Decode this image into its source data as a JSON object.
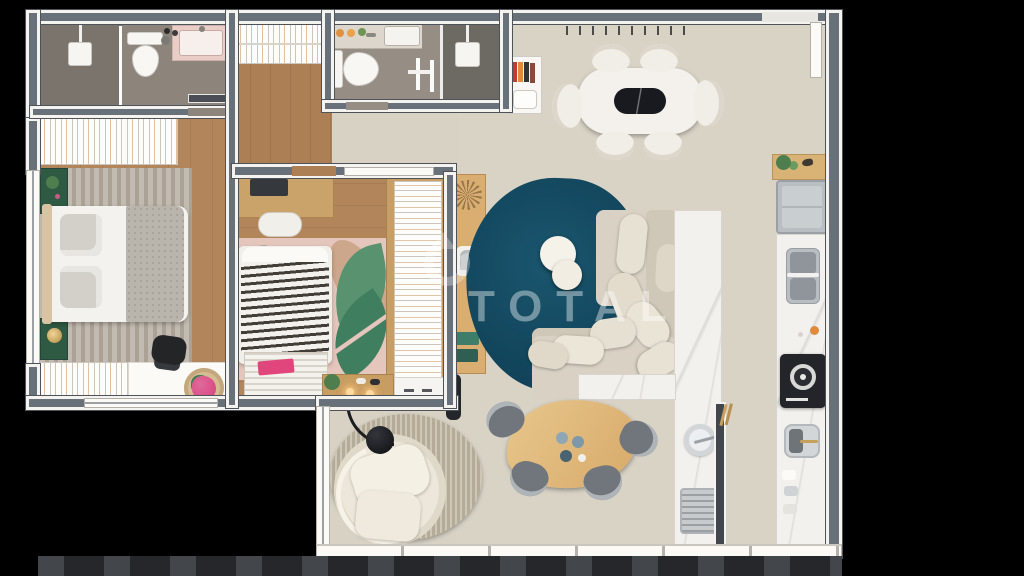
{
  "watermark": {
    "text": "TOTAL"
  },
  "scene": {
    "type": "apartment-floor-plan-3d-render",
    "view": "top-down",
    "background": "#000000"
  },
  "palette": {
    "wall_core": "#687079",
    "wall_edge": "#f4f3ef",
    "living_floor": "#d9d3c6",
    "wood_floor": "#b2855a",
    "bath_floor": "#93897f",
    "shower_floor": "#6d6963",
    "teal_rug": "#14506a",
    "wood_furniture": "#d9ae70",
    "sofa_beige": "#d8d1c3",
    "marble": "#f3f1ed",
    "green_accent": "#2e5a43",
    "pink_accent": "#d6407e",
    "cooktop_black": "#23252b",
    "fridge_gray": "#b9bec2",
    "exterior_band": "#25272b"
  },
  "rooms": [
    {
      "name": "ensuite-bathroom",
      "furniture": [
        "walk-in-shower",
        "toilet",
        "vanity-sink"
      ]
    },
    {
      "name": "hallway",
      "furniture": [
        "slatted-closet"
      ]
    },
    {
      "name": "bathroom-2",
      "furniture": [
        "vanity-sink",
        "toilet",
        "towel-rail",
        "shower-cabin"
      ]
    },
    {
      "name": "master-bedroom",
      "furniture": [
        "slatted-wardrobe",
        "double-bed",
        "nightstand-with-plant",
        "nightstand-with-lamp",
        "striped-rug",
        "desk",
        "office-chair",
        "slatted-dresser",
        "flower-basket"
      ]
    },
    {
      "name": "second-bedroom",
      "furniture": [
        "desk-with-laptop",
        "desk-chair",
        "single-bed-zebra-duvet",
        "foot-bench",
        "tropical-leaf-rug",
        "slatted-wardrobe",
        "media-shelf-with-lamps",
        "white-cabinet"
      ]
    },
    {
      "name": "living-dining-room",
      "furniture": [
        "dining-table",
        "marble-tray",
        "dining-chairs",
        "wall-peg-rack",
        "book-shelf",
        "sideboard",
        "teal-area-rug",
        "poufs",
        "l-shaped-sofa",
        "pillows"
      ]
    },
    {
      "name": "kitchen",
      "furniture": [
        "plant-counter",
        "fridge",
        "double-sink",
        "cooktop",
        "prep-sink",
        "marble-island",
        "bar-sink",
        "vented-appliance"
      ]
    },
    {
      "name": "lounge-corner",
      "furniture": [
        "round-striped-rug",
        "swivel-armchair",
        "arc-floor-lamp",
        "coffee-table",
        "gray-chairs",
        "tall-vase"
      ]
    }
  ],
  "counts": {
    "dining_chairs": 6,
    "coffee_table_chairs": 4,
    "wall_pegs": 10,
    "poufs": 2
  }
}
